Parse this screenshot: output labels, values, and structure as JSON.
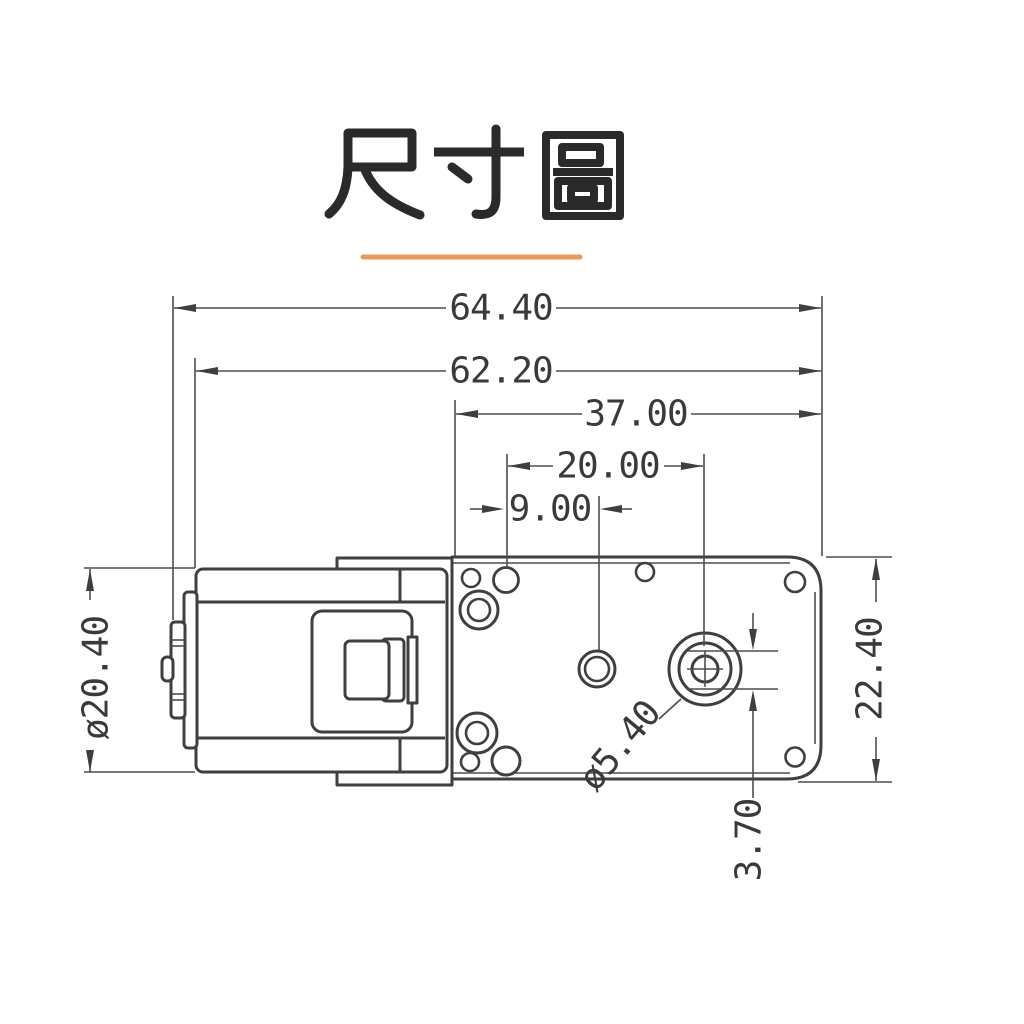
{
  "header": {
    "title": "尺寸圖"
  },
  "dimensions": {
    "overall_width": "64.40",
    "motor_body_width": "62.20",
    "gearbox_plate_width": "37.00",
    "shaft_to_gear_center": "20.00",
    "hole_to_gear_center": "9.00",
    "motor_diameter": "ø20.40",
    "plate_height": "22.40",
    "shaft_flat_width": "3.70",
    "shaft_boss_diameter": "ø5.40"
  },
  "colors": {
    "accent_underline": "#E59A5E",
    "drawing_line": "#3f3f3f",
    "dimension_line": "#4d4d4d",
    "text": "#3a3a3a"
  }
}
